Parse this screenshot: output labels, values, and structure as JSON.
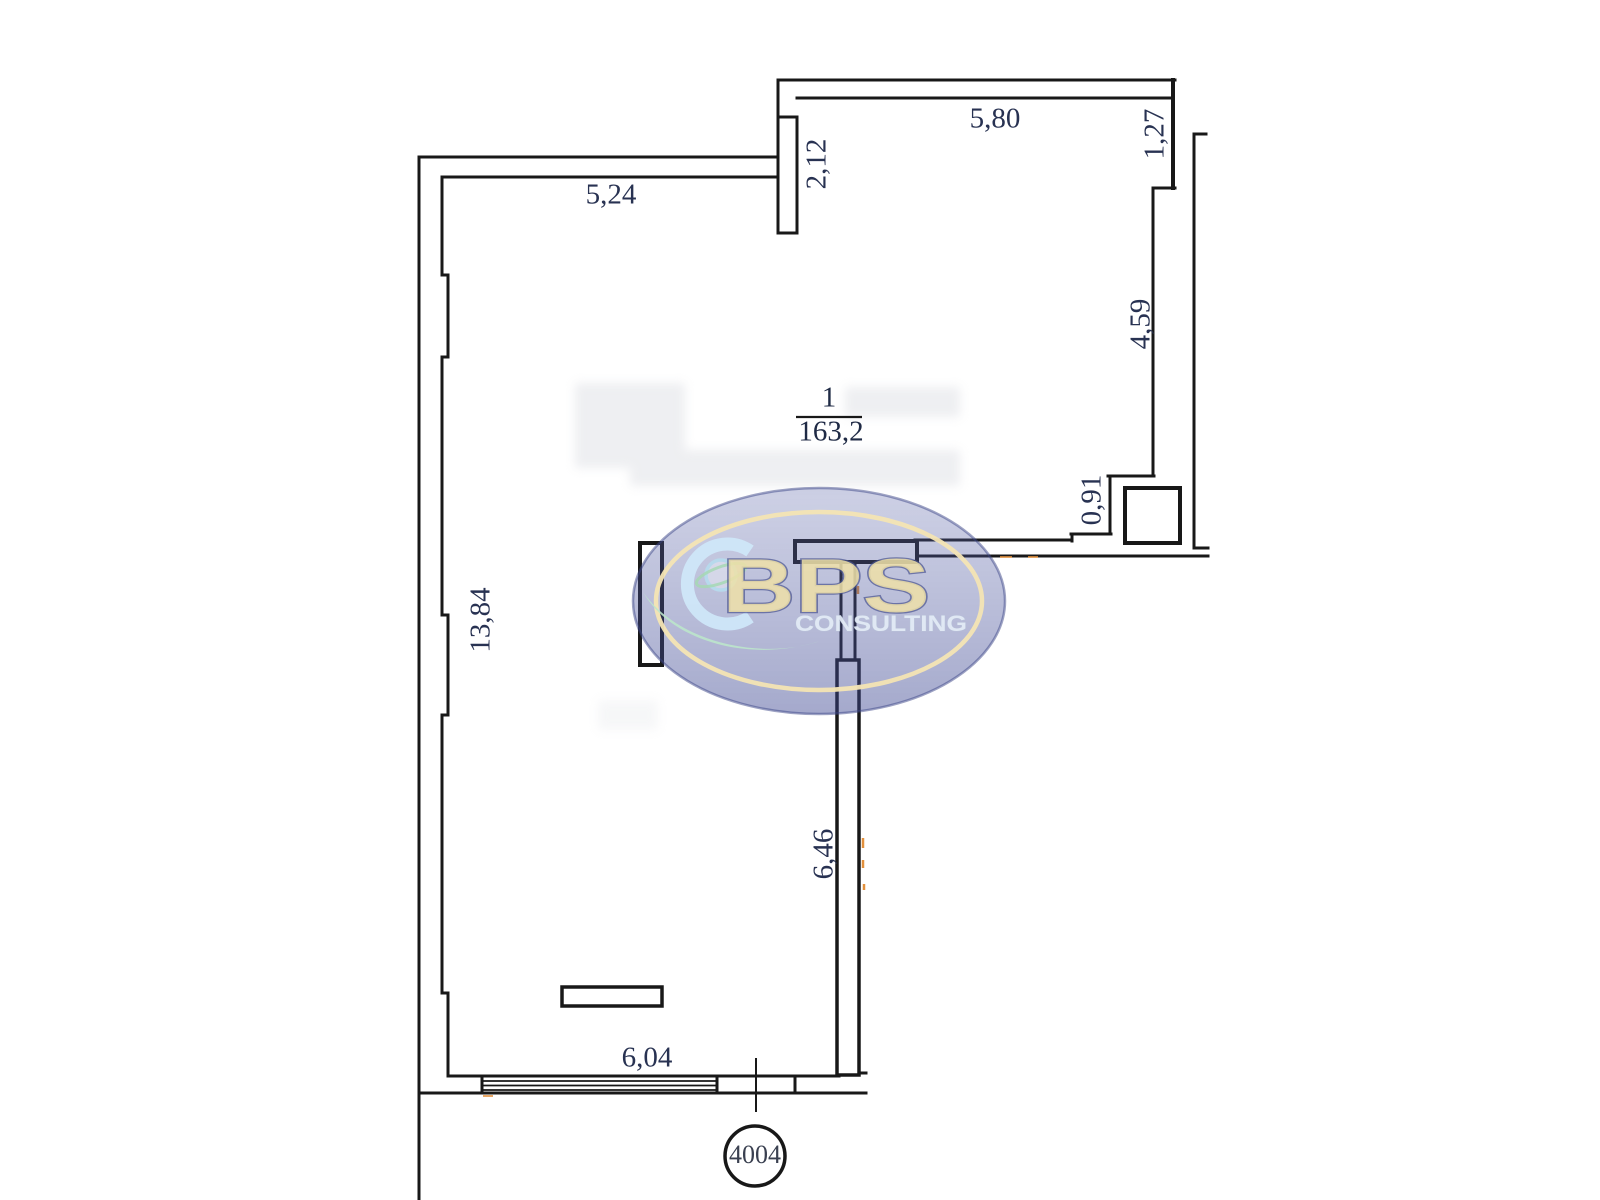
{
  "plan": {
    "room": {
      "number": "1",
      "area": "163,2"
    },
    "unit_badge": {
      "number": "4004"
    },
    "dimensions": {
      "top_left_width": "5,24",
      "top_width": "5,80",
      "entry_pier_height": "2,12",
      "right_upper_height": "1,27",
      "right_height": "4,59",
      "right_step_height": "0,91",
      "left_height": "13,84",
      "interior_wall_height": "6,46",
      "bottom_width": "6,04"
    }
  },
  "watermark": {
    "brand": "BPS",
    "subtitle": "CONSULTING"
  },
  "colors": {
    "wall_line": "#181818",
    "dimension_text": "#283252",
    "watermark_navy": "#4a5490",
    "watermark_cream_ring": "#f4e5b4",
    "watermark_letter_yellow": "#eee0a8",
    "watermark_green": "#bce5cb",
    "watermark_light_blue": "#cfe8fa",
    "accent_orange": "#e2903d"
  }
}
